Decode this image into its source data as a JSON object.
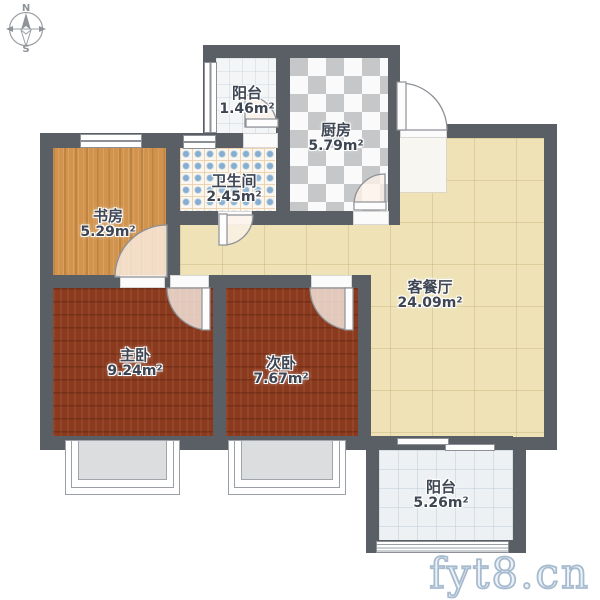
{
  "compass": {
    "north": "N",
    "south": "S"
  },
  "rooms": [
    {
      "id": "balcony-top",
      "name": "阳台",
      "area": "1.46m²"
    },
    {
      "id": "kitchen",
      "name": "厨房",
      "area": "5.79m²"
    },
    {
      "id": "bathroom",
      "name": "卫生间",
      "area": "2.45m²"
    },
    {
      "id": "study",
      "name": "书房",
      "area": "5.29m²"
    },
    {
      "id": "living-dining",
      "name": "客餐厅",
      "area": "24.09m²"
    },
    {
      "id": "master-bedroom",
      "name": "主卧",
      "area": "9.24m²"
    },
    {
      "id": "second-bedroom",
      "name": "次卧",
      "area": "7.67m²"
    },
    {
      "id": "balcony-bottom",
      "name": "阳台",
      "area": "5.26m²"
    }
  ],
  "watermark": "fyt8.cn",
  "palette": {
    "wall": "#5a5f66",
    "living_floor": "#eee2b6",
    "study_floor": "#d2944d",
    "bedroom_floor": "#8b3a1e",
    "kitchen_tile_dark": "#c6c7c9",
    "kitchen_tile_light": "#fafafa",
    "bathroom_dot": "#85aed2",
    "balcony_floor": "#edf1f4",
    "label_text": "#3e4654",
    "watermark_stroke": "#a3b8cd"
  }
}
